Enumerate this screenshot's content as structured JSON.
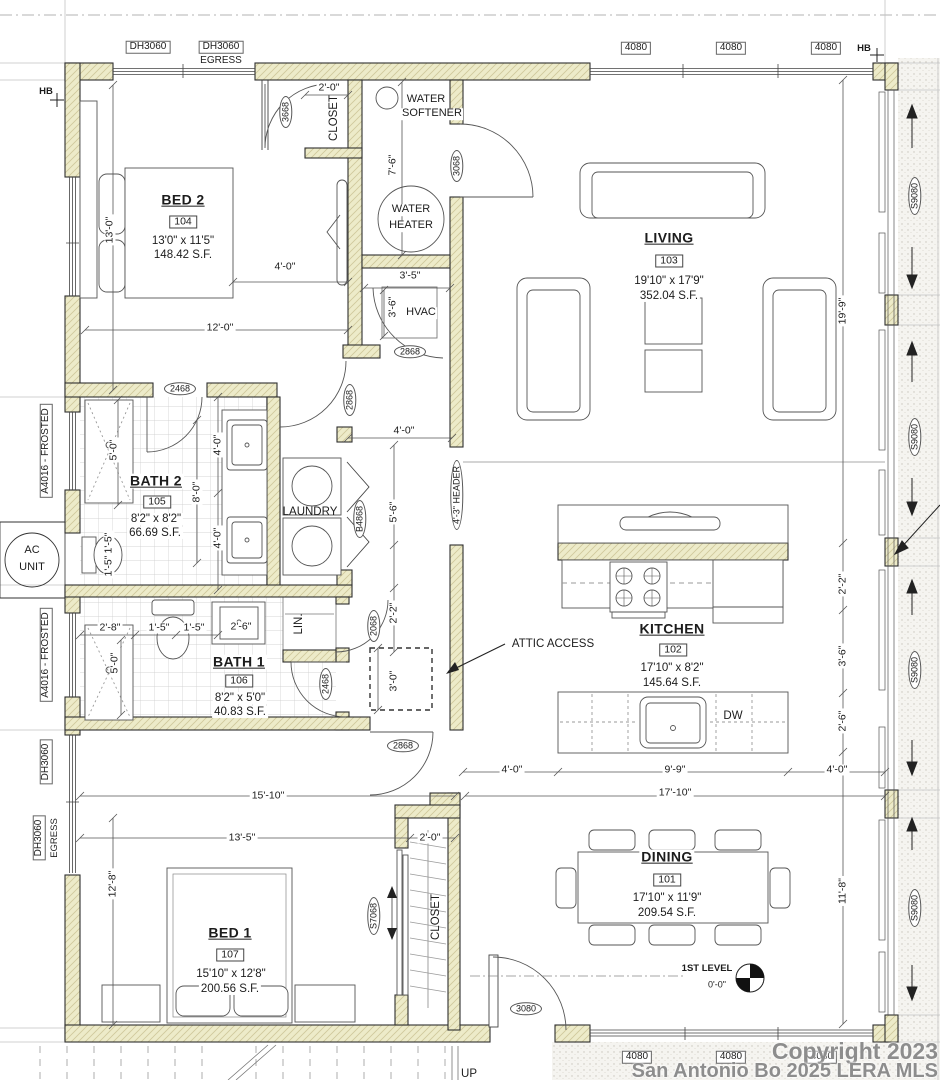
{
  "rooms": {
    "bed2": {
      "name": "BED 2",
      "tag": "104",
      "size": "13'0\" x 11'5\"",
      "area": "148.42 S.F."
    },
    "living": {
      "name": "LIVING",
      "tag": "103",
      "size": "19'10\" x 17'9\"",
      "area": "352.04 S.F."
    },
    "bath2": {
      "name": "BATH 2",
      "tag": "105",
      "size": "8'2\" x 8'2\"",
      "area": "66.69 S.F."
    },
    "kitchen": {
      "name": "KITCHEN",
      "tag": "102",
      "size": "17'10\" x 8'2\"",
      "area": "145.64 S.F."
    },
    "bath1": {
      "name": "BATH 1",
      "tag": "106",
      "size": "8'2\" x 5'0\"",
      "area": "40.83 S.F."
    },
    "bed1": {
      "name": "BED 1",
      "tag": "107",
      "size": "15'10\" x 12'8\"",
      "area": "200.56 S.F."
    },
    "dining": {
      "name": "DINING",
      "tag": "101",
      "size": "17'10\" x 11'9\"",
      "area": "209.54 S.F."
    }
  },
  "labels": {
    "laundry": "LAUNDRY",
    "lin": "LIN.",
    "closet": "CLOSET",
    "water": "WATER",
    "softener": "SOFTENER",
    "heater": "HEATER",
    "hvac": "HVAC",
    "ac": "AC",
    "unit": "UNIT",
    "attic_access": "ATTIC ACCESS",
    "dw": "DW",
    "up": "UP",
    "first_level": "1ST LEVEL",
    "level_elev": "0'-0\""
  },
  "doors": {
    "d3668": "3668",
    "d3068": "3068",
    "d2868": "2868",
    "d2468": "2468",
    "b4868": "B4868",
    "d2068": "2068",
    "s7068": "S7068",
    "d3080": "3080",
    "s9080": "S9080"
  },
  "windows": {
    "dh3060": "DH3060",
    "egress": "EGRESS",
    "w4080": "4080",
    "a4016": "A4016 - FROSTED",
    "hb": "HB",
    "header": "4'-3\" HEADER"
  },
  "dims": {
    "d13_0": "13'-0\"",
    "d12_0": "12'-0\"",
    "d4_0": "4'-0\"",
    "d2_0": "2'-0\"",
    "d7_6": "7'-6\"",
    "d3_5": "3'-5\"",
    "d3_6": "3'-6\"",
    "d19_9": "19'-9\"",
    "d5_0": "5'-0\"",
    "d8_0": "8'-0\"",
    "d1_5": "1'-5\"",
    "d2_8": "2'-8\"",
    "d2_6": "2'-6\"",
    "d5_6": "5'-6\"",
    "d2_2": "2'-2\"",
    "d3_0": "3'-0\"",
    "d15_10": "15'-10\"",
    "d13_5": "13'-5\"",
    "d17_10": "17'-10\"",
    "d9_9": "9'-9\"",
    "d11_8": "11'-8\"",
    "d12_8": "12'-8\""
  },
  "watermark": {
    "line1": "Copyright 2023",
    "line2": "San Antonio Bo 2025 LERA MLS"
  }
}
